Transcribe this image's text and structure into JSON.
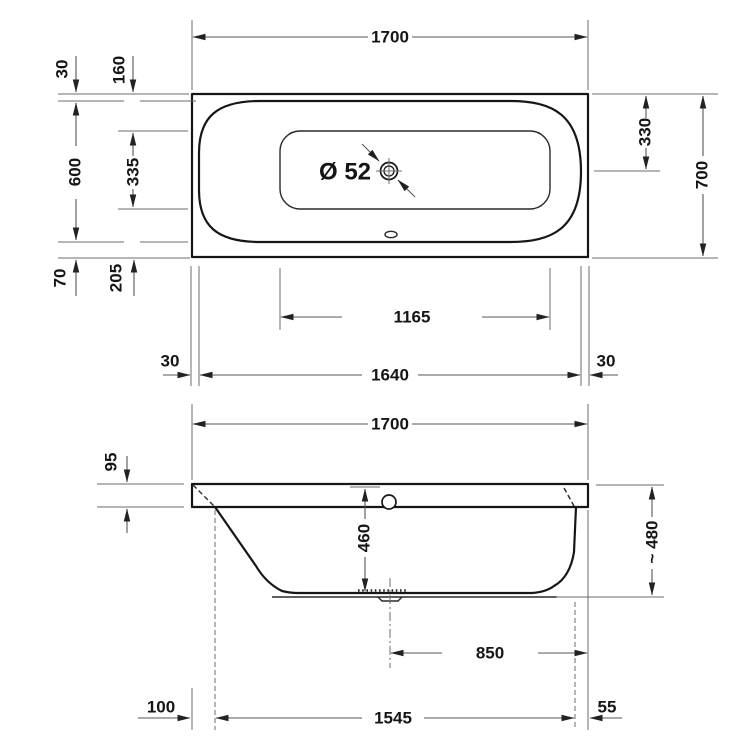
{
  "drawing_title": "Bathtub technical drawing — plan and section views",
  "colors": {
    "background": "#ffffff",
    "outline": "#161616",
    "dimension_lines": "#555555"
  },
  "top_view": {
    "name": "plan view",
    "labels": {
      "length_overall": "1700",
      "width_overall": "700",
      "rim_offset_top": "30",
      "floor_offset_top": "160",
      "width_inner": "600",
      "floor_width": "335",
      "rim_offset_bottom": "70",
      "floor_offset_bottom": "205",
      "drain_diameter": "Ø 52",
      "drain_center_from_top": "330",
      "floor_length": "1165",
      "rim_offset_left": "30",
      "length_inner": "1640",
      "rim_offset_right": "30"
    }
  },
  "side_view": {
    "name": "section view",
    "labels": {
      "length_overall": "1700",
      "rim_height": "95",
      "inner_depth": "460",
      "height_overall": "~ 480",
      "drain_center_from_right": "850",
      "base_offset_left": "100",
      "base_length": "1545",
      "base_offset_right": "55"
    }
  }
}
